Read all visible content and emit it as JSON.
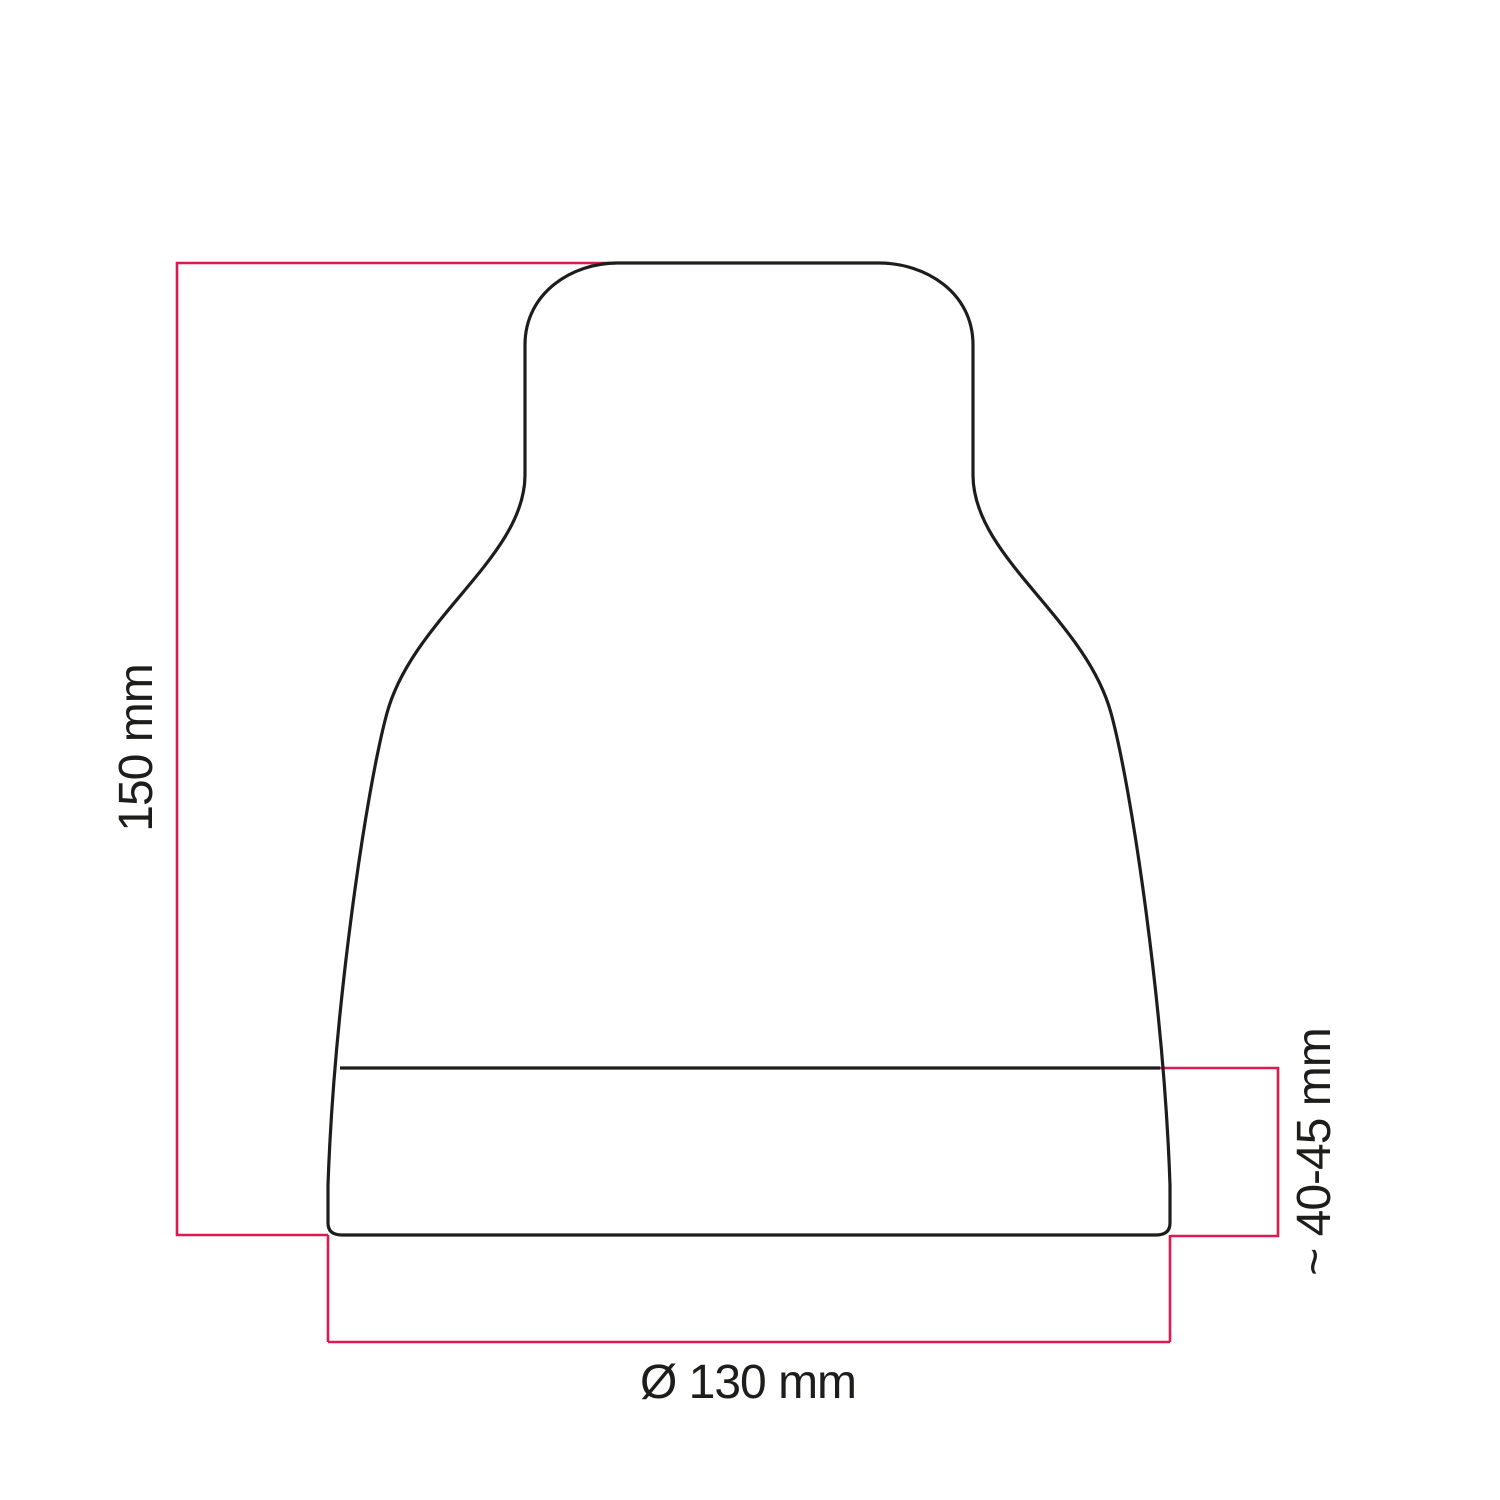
{
  "drawing": {
    "kind": "technical dimension drawing",
    "labels": {
      "height": "150 mm",
      "diameter": "Ø 130 mm",
      "depth": "~ 40-45 mm"
    },
    "colors": {
      "outline": "#1d1d1b",
      "dimension_line": "#dc1950",
      "label_text": "#1d1d1b",
      "background": "#ffffff"
    }
  }
}
